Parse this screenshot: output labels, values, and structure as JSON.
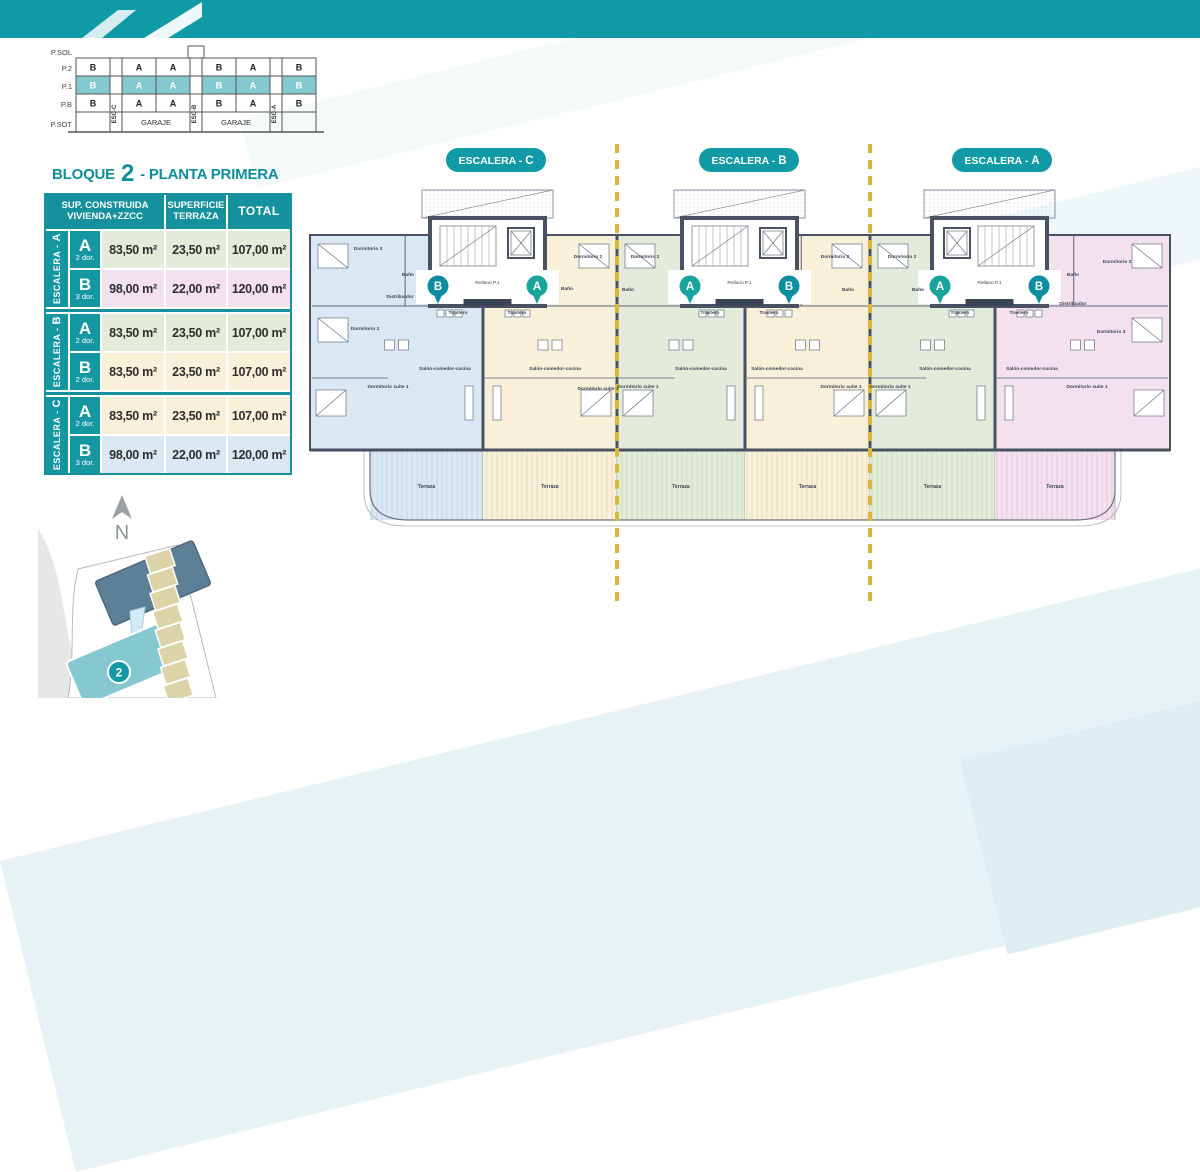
{
  "colors": {
    "teal": "#0f9aa5",
    "teal_dark": "#0d8f9a",
    "wall": "#4a5163",
    "dash_yellow": "#dcb73e",
    "unit_blue": "#dbe7f3",
    "unit_cream": "#f8f0d9",
    "unit_green": "#e3ecda",
    "unit_pink": "#f3e2ee",
    "hatch_blue": "#c3d4e8",
    "hatch_cream": "#e8dcb5",
    "hatch_green": "#ccdcba",
    "hatch_pink": "#e4c8dc",
    "band_light": "#e9f3f6"
  },
  "stack_diagram": {
    "floors": [
      "P.SOL",
      "P.2",
      "P.1",
      "P.B",
      "P.SOT"
    ],
    "row_p2": [
      "B",
      "A",
      "A",
      "B",
      "A",
      "B"
    ],
    "row_p1": [
      "B",
      "A",
      "A",
      "B",
      "A",
      "B"
    ],
    "row_pb": [
      "B",
      "A",
      "A",
      "B",
      "A",
      "B"
    ],
    "esc_cols": [
      "ESC-C",
      "ESC-B",
      "ESC-A"
    ],
    "garage_label": "GARAJE"
  },
  "summary_table": {
    "title": {
      "prefix": "BLOQUE",
      "number": "2",
      "suffix": "- PLANTA PRIMERA"
    },
    "headers": {
      "col1_line1": "SUP. CONSTRUIDA",
      "col1_line2": "VIVIENDA+ZZCC",
      "col2_line1": "SUPERFICIE",
      "col2_line2": "TERRAZA",
      "col3": "TOTAL"
    },
    "groups": [
      {
        "label_prefix": "ESCALERA - ",
        "label_letter": "A",
        "rows": [
          {
            "unit": "A",
            "dorms": "2 dor.",
            "built": "83,50 m²",
            "terrace": "23,50 m²",
            "total": "107,00 m²",
            "bg": "#e3ecda"
          },
          {
            "unit": "B",
            "dorms": "3 dor.",
            "built": "98,00 m²",
            "terrace": "22,00 m²",
            "total": "120,00 m²",
            "bg": "#f3e2ee"
          }
        ]
      },
      {
        "label_prefix": "ESCALERA - ",
        "label_letter": "B",
        "rows": [
          {
            "unit": "A",
            "dorms": "2 dor.",
            "built": "83,50 m²",
            "terrace": "23,50 m²",
            "total": "107,00 m²",
            "bg": "#e3ecda"
          },
          {
            "unit": "B",
            "dorms": "2 dor.",
            "built": "83,50 m²",
            "terrace": "23,50 m²",
            "total": "107,00 m²",
            "bg": "#f8f0d9"
          }
        ]
      },
      {
        "label_prefix": "ESCALERA - ",
        "label_letter": "C",
        "rows": [
          {
            "unit": "A",
            "dorms": "2 dor.",
            "built": "83,50 m²",
            "terrace": "23,50 m²",
            "total": "107,00 m²",
            "bg": "#f8f0d9"
          },
          {
            "unit": "B",
            "dorms": "3 dor.",
            "built": "98,00 m²",
            "terrace": "22,00 m²",
            "total": "120,00 m²",
            "bg": "#dbe7f3"
          }
        ]
      }
    ]
  },
  "plan": {
    "pills": [
      {
        "prefix": "ESCALERA - ",
        "letter": "C"
      },
      {
        "prefix": "ESCALERA - ",
        "letter": "B"
      },
      {
        "prefix": "ESCALERA - ",
        "letter": "A"
      }
    ],
    "badges": [
      "B",
      "A",
      "A",
      "B",
      "A",
      "B"
    ],
    "rellano_label": "Rellano P.1",
    "terrace_label": "Terraza",
    "room_labels": [
      {
        "t": "Dormitorio 3",
        "x": 63,
        "y": 112
      },
      {
        "t": "Baño",
        "x": 103,
        "y": 138
      },
      {
        "t": "Distribuidor",
        "x": 95,
        "y": 160
      },
      {
        "t": "Dormitorio 2",
        "x": 60,
        "y": 192
      },
      {
        "t": "Dormitorio suite 1",
        "x": 83,
        "y": 250
      },
      {
        "t": "Salón-comedor-cocina",
        "x": 140,
        "y": 232
      },
      {
        "t": "Dormitorio 2",
        "x": 283,
        "y": 120
      },
      {
        "t": "Baño",
        "x": 262,
        "y": 152
      },
      {
        "t": "Salón-comedor-cocina",
        "x": 250,
        "y": 232
      },
      {
        "t": "Dormitorio suite 1",
        "x": 293,
        "y": 252
      },
      {
        "t": "Dormitorio 2",
        "x": 340,
        "y": 120
      },
      {
        "t": "Baño",
        "x": 323,
        "y": 153
      },
      {
        "t": "Salón-comedor-cocina",
        "x": 396,
        "y": 232
      },
      {
        "t": "Dormitorio suite 1",
        "x": 333,
        "y": 250
      },
      {
        "t": "Dormitorio 2",
        "x": 530,
        "y": 120
      },
      {
        "t": "Baño",
        "x": 543,
        "y": 153
      },
      {
        "t": "Salón-comedor-cocina",
        "x": 472,
        "y": 232
      },
      {
        "t": "Dormitorio suite 1",
        "x": 536,
        "y": 250
      },
      {
        "t": "Dormitorio 2",
        "x": 597,
        "y": 120
      },
      {
        "t": "Baño",
        "x": 613,
        "y": 153
      },
      {
        "t": "Salón-comedor-cocina",
        "x": 640,
        "y": 232
      },
      {
        "t": "Dormitorio suite 1",
        "x": 585,
        "y": 250
      },
      {
        "t": "Dormitorio 2",
        "x": 812,
        "y": 125
      },
      {
        "t": "Baño",
        "x": 768,
        "y": 138
      },
      {
        "t": "Distribuidor",
        "x": 768,
        "y": 167
      },
      {
        "t": "Dormitorio 3",
        "x": 806,
        "y": 195
      },
      {
        "t": "Dormitorio suite 1",
        "x": 782,
        "y": 250
      },
      {
        "t": "Salón-comedor-cocina",
        "x": 727,
        "y": 232
      },
      {
        "t": "Trastero",
        "x": 153,
        "y": 176
      },
      {
        "t": "Trastero",
        "x": 212,
        "y": 176
      },
      {
        "t": "Trastero",
        "x": 405,
        "y": 176
      },
      {
        "t": "Trastero",
        "x": 464,
        "y": 176
      },
      {
        "t": "Trastero",
        "x": 655,
        "y": 176
      },
      {
        "t": "Trastero",
        "x": 714,
        "y": 176
      }
    ]
  },
  "site_map": {
    "north_letter": "N",
    "block_badge": "2"
  }
}
